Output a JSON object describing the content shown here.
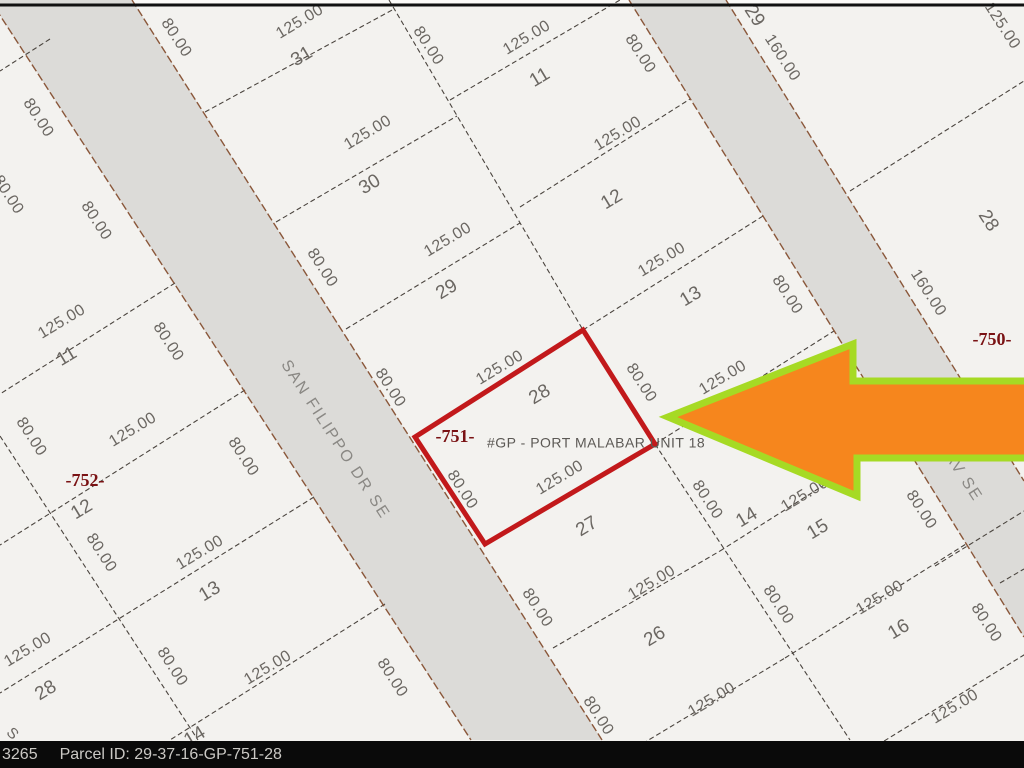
{
  "statusbar": {
    "id": "3265",
    "parcel_label": "Parcel ID: 29-37-16-GP-751-28"
  },
  "map": {
    "colors": {
      "paper": "#F3F2EF",
      "paper_top_strip": "#FBFAF8",
      "road_fill": "#DCDBD8",
      "top_border": "#111111",
      "parcel_outline": "#C2191B",
      "arrow_fill": "#F6861D",
      "arrow_stroke": "#A6DA24"
    },
    "top_border_y": 5,
    "roads": [
      {
        "id": "san-filippo-dr-se",
        "pts": "-10,0 132,0 602,740 471,740"
      },
      {
        "id": "av-se",
        "pts": "629,0 726,0 1024,481 1024,637"
      }
    ],
    "road_edges": [
      [
        -10,
        0,
        471,
        740
      ],
      [
        132,
        0,
        602,
        740
      ],
      [
        629,
        0,
        1024,
        637
      ],
      [
        726,
        0,
        1024,
        481
      ]
    ],
    "lines": [
      [
        205,
        112,
        394,
        9
      ],
      [
        276,
        222,
        457,
        116
      ],
      [
        346,
        329,
        520,
        223
      ],
      [
        553,
        648,
        720,
        551
      ],
      [
        622,
        756,
        785,
        658
      ],
      [
        450,
        100,
        620,
        0
      ],
      [
        520,
        207,
        690,
        99
      ],
      [
        583,
        330,
        763,
        216
      ],
      [
        655,
        444,
        834,
        331
      ],
      [
        720,
        551,
        900,
        437
      ],
      [
        785,
        658,
        966,
        544
      ],
      [
        850,
        762,
        1032,
        650
      ],
      [
        389,
        0,
        583,
        330
      ],
      [
        655,
        444,
        850,
        740
      ],
      [
        175,
        283,
        0,
        394
      ],
      [
        245,
        390,
        0,
        545
      ],
      [
        314,
        497,
        0,
        693
      ],
      [
        385,
        604,
        170,
        740
      ],
      [
        0,
        436,
        198,
        740
      ],
      [
        50,
        39,
        0,
        71
      ],
      [
        850,
        191,
        1024,
        81
      ],
      [
        935,
        566,
        1024,
        511
      ],
      [
        1000,
        583,
        1024,
        569
      ]
    ],
    "parcel": {
      "pts": "415,437 583,330 655,444 485,544"
    },
    "arrow": {
      "pts": "668,417 853,344 853,381 1030,381 1030,458 857,458 857,496"
    },
    "labels": [
      {
        "t": "80.00",
        "x": 38,
        "y": 118,
        "r": 57,
        "c": "dim"
      },
      {
        "t": "80.00",
        "x": 96,
        "y": 221,
        "r": 57,
        "c": "dim"
      },
      {
        "t": "80.00",
        "x": 8,
        "y": 195,
        "r": 57,
        "c": "dim"
      },
      {
        "t": "80.00",
        "x": 176,
        "y": 38,
        "r": 57,
        "c": "dim"
      },
      {
        "t": "125.00",
        "x": 300,
        "y": 22,
        "r": -31,
        "c": "dim"
      },
      {
        "t": "125.00",
        "x": 527,
        "y": 38,
        "r": -31,
        "c": "dim"
      },
      {
        "t": "80.00",
        "x": 428,
        "y": 46,
        "r": 57,
        "c": "dim"
      },
      {
        "t": "80.00",
        "x": 640,
        "y": 54,
        "r": 57,
        "c": "dim"
      },
      {
        "t": "125.00",
        "x": 62,
        "y": 322,
        "r": -31,
        "c": "dim"
      },
      {
        "t": "80.00",
        "x": 168,
        "y": 342,
        "r": 57,
        "c": "dim"
      },
      {
        "t": "80.00",
        "x": 31,
        "y": 437,
        "r": 57,
        "c": "dim"
      },
      {
        "t": "125.00",
        "x": 133,
        "y": 430,
        "r": -31,
        "c": "dim"
      },
      {
        "t": "125.00",
        "x": 368,
        "y": 133,
        "r": -31,
        "c": "dim"
      },
      {
        "t": "80.00",
        "x": 322,
        "y": 268,
        "r": 57,
        "c": "dim"
      },
      {
        "t": "125.00",
        "x": 448,
        "y": 240,
        "r": -31,
        "c": "dim"
      },
      {
        "t": "80.00",
        "x": 390,
        "y": 388,
        "r": 57,
        "c": "dim"
      },
      {
        "t": "80.00",
        "x": 101,
        "y": 553,
        "r": 57,
        "c": "dim"
      },
      {
        "t": "125.00",
        "x": 200,
        "y": 553,
        "r": -31,
        "c": "dim"
      },
      {
        "t": "80.00",
        "x": 243,
        "y": 457,
        "r": 57,
        "c": "dim"
      },
      {
        "t": "125.00",
        "x": 618,
        "y": 134,
        "r": -31,
        "c": "dim"
      },
      {
        "t": "125.00",
        "x": 662,
        "y": 260,
        "r": -31,
        "c": "dim"
      },
      {
        "t": "80.00",
        "x": 787,
        "y": 295,
        "r": 57,
        "c": "dim"
      },
      {
        "t": "125.00",
        "x": 500,
        "y": 368,
        "r": -31,
        "c": "dim"
      },
      {
        "t": "80.00",
        "x": 641,
        "y": 383,
        "r": 57,
        "c": "dim"
      },
      {
        "t": "80.00",
        "x": 462,
        "y": 490,
        "r": 57,
        "c": "dim"
      },
      {
        "t": "125.00",
        "x": 560,
        "y": 478,
        "r": -31,
        "c": "dim"
      },
      {
        "t": "125.00",
        "x": 723,
        "y": 378,
        "r": -31,
        "c": "dim"
      },
      {
        "t": "80.00",
        "x": 707,
        "y": 500,
        "r": 57,
        "c": "dim"
      },
      {
        "t": "125.00",
        "x": 805,
        "y": 495,
        "r": -31,
        "c": "dim"
      },
      {
        "t": "80.00",
        "x": 921,
        "y": 510,
        "r": 57,
        "c": "dim"
      },
      {
        "t": "125.00",
        "x": 28,
        "y": 650,
        "r": -31,
        "c": "dim"
      },
      {
        "t": "80.00",
        "x": 172,
        "y": 667,
        "r": 57,
        "c": "dim"
      },
      {
        "t": "125.00",
        "x": 268,
        "y": 668,
        "r": -31,
        "c": "dim"
      },
      {
        "t": "80.00",
        "x": 537,
        "y": 608,
        "r": 57,
        "c": "dim"
      },
      {
        "t": "125.00",
        "x": 652,
        "y": 583,
        "r": -31,
        "c": "dim"
      },
      {
        "t": "125.00",
        "x": 712,
        "y": 700,
        "r": -31,
        "c": "dim"
      },
      {
        "t": "80.00",
        "x": 598,
        "y": 716,
        "r": 57,
        "c": "dim"
      },
      {
        "t": "80.00",
        "x": 778,
        "y": 605,
        "r": 57,
        "c": "dim"
      },
      {
        "t": "125.00",
        "x": 880,
        "y": 598,
        "r": -31,
        "c": "dim"
      },
      {
        "t": "80.00",
        "x": 986,
        "y": 623,
        "r": 57,
        "c": "dim"
      },
      {
        "t": "125.00",
        "x": 955,
        "y": 707,
        "r": -31,
        "c": "dim"
      },
      {
        "t": "80.00",
        "x": 392,
        "y": 678,
        "r": 57,
        "c": "dim"
      },
      {
        "t": "160.00",
        "x": 782,
        "y": 58,
        "r": 57,
        "c": "dim"
      },
      {
        "t": "160.00",
        "x": 928,
        "y": 293,
        "r": 57,
        "c": "dim"
      },
      {
        "t": "125.00",
        "x": 1002,
        "y": 26,
        "r": 57,
        "c": "dim"
      },
      {
        "t": "31",
        "x": 302,
        "y": 57,
        "r": -31,
        "c": "num"
      },
      {
        "t": "30",
        "x": 370,
        "y": 185,
        "r": -31,
        "c": "num"
      },
      {
        "t": "29",
        "x": 447,
        "y": 290,
        "r": -31,
        "c": "num"
      },
      {
        "t": "28",
        "x": 540,
        "y": 395,
        "r": -31,
        "c": "num"
      },
      {
        "t": "27",
        "x": 587,
        "y": 527,
        "r": -31,
        "c": "num"
      },
      {
        "t": "26",
        "x": 655,
        "y": 637,
        "r": -31,
        "c": "num"
      },
      {
        "t": "11",
        "x": 67,
        "y": 357,
        "r": -31,
        "c": "num"
      },
      {
        "t": "12",
        "x": 82,
        "y": 510,
        "r": -31,
        "c": "num"
      },
      {
        "t": "13",
        "x": 210,
        "y": 592,
        "r": -31,
        "c": "num"
      },
      {
        "t": "28",
        "x": 46,
        "y": 691,
        "r": -31,
        "c": "num"
      },
      {
        "t": "14",
        "x": 195,
        "y": 737,
        "r": -31,
        "c": "num"
      },
      {
        "t": "11",
        "x": 540,
        "y": 78,
        "r": -31,
        "c": "num"
      },
      {
        "t": "12",
        "x": 612,
        "y": 200,
        "r": -31,
        "c": "num"
      },
      {
        "t": "13",
        "x": 691,
        "y": 297,
        "r": -31,
        "c": "num"
      },
      {
        "t": "14",
        "x": 747,
        "y": 518,
        "r": -31,
        "c": "num"
      },
      {
        "t": "15",
        "x": 818,
        "y": 530,
        "r": -31,
        "c": "num"
      },
      {
        "t": "16",
        "x": 899,
        "y": 630,
        "r": -31,
        "c": "num"
      },
      {
        "t": "29",
        "x": 754,
        "y": 16,
        "r": 57,
        "c": "num"
      },
      {
        "t": "28",
        "x": 988,
        "y": 221,
        "r": 57,
        "c": "num"
      },
      {
        "t": "-752-",
        "x": 85,
        "y": 482,
        "r": 0,
        "c": "block"
      },
      {
        "t": "-751-",
        "x": 455,
        "y": 438,
        "r": 0,
        "c": "block"
      },
      {
        "t": "-750-",
        "x": 992,
        "y": 341,
        "r": 0,
        "c": "block"
      },
      {
        "t": "SAN FILIPPO DR SE",
        "x": 335,
        "y": 440,
        "r": 57,
        "c": "street"
      },
      {
        "t": "AV SE",
        "x": 963,
        "y": 477,
        "r": 57,
        "c": "street"
      },
      {
        "t": "#GP - PORT MALABAR UNIT 18",
        "x": 487,
        "y": 444,
        "r": 0,
        "c": "anno"
      },
      {
        "t": "S",
        "x": 12,
        "y": 734,
        "r": 45,
        "c": "misc"
      }
    ]
  }
}
